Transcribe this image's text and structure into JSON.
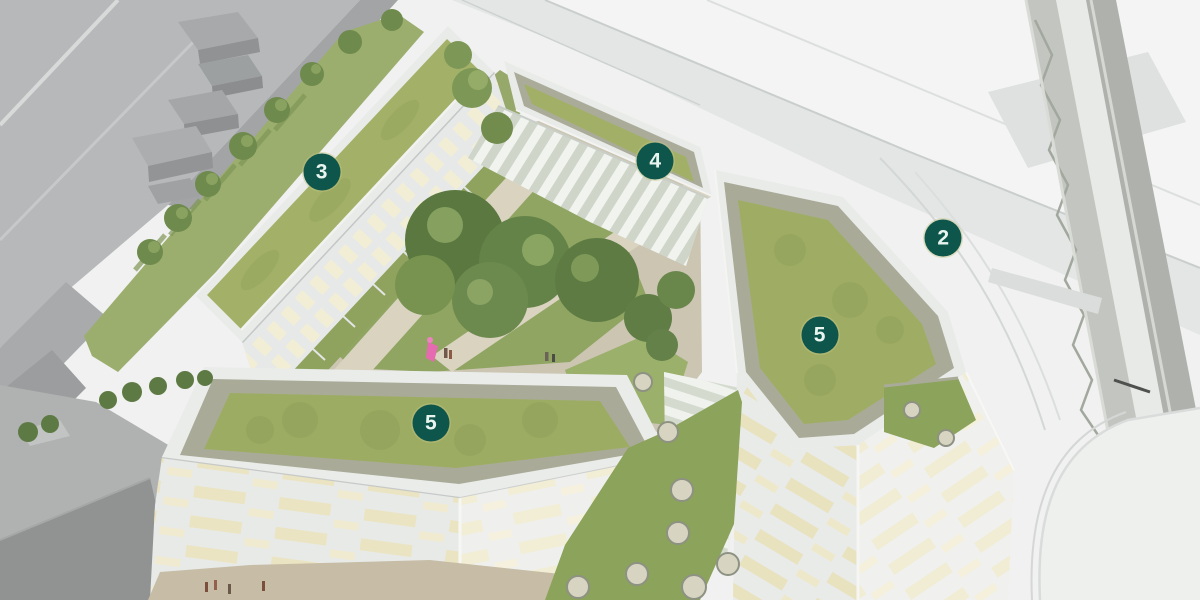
{
  "scene": {
    "kind": "aerial-architectural-rendering",
    "features": {
      "green_roof_buildings": 4,
      "numbered_markers": 5
    }
  },
  "markers": [
    {
      "label": "3",
      "x_pct": 26.8,
      "y_pct": 28.6
    },
    {
      "label": "4",
      "x_pct": 54.6,
      "y_pct": 26.8
    },
    {
      "label": "2",
      "x_pct": 78.6,
      "y_pct": 39.6
    },
    {
      "label": "5",
      "x_pct": 68.3,
      "y_pct": 55.8
    },
    {
      "label": "5",
      "x_pct": 35.9,
      "y_pct": 70.5
    }
  ],
  "colors": {
    "marker_bg": "#0e564b",
    "marker_text": "#e8f5ef",
    "roof_grass": "#a0ae66",
    "gravel_border": "#a9ab98",
    "courtyard_lawn": "#90a562",
    "tree_green": "#5c7a41",
    "facade_white": "#eceeec",
    "window_cream": "#efe8c6",
    "context_gray": "#b2b4b5",
    "road_gray": "#e3e6e5",
    "ground_white": "#f1f2f1",
    "accent_pink": "#e56ab0"
  }
}
